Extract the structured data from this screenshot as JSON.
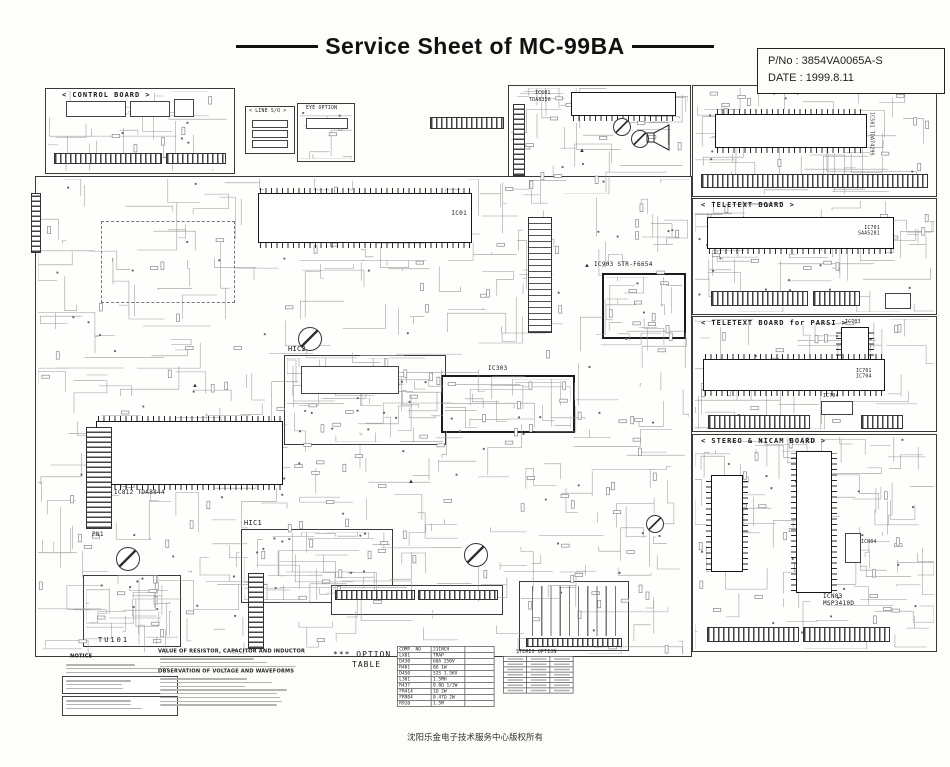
{
  "title": "Service Sheet of MC-99BA",
  "footer": "沈阳乐金电子技术服务中心版权所有",
  "info": {
    "pno": "P/No : 3854VA0065A-S",
    "date": "DATE : 1999.8.11"
  },
  "boards": {
    "control": {
      "label": "< CONTROL BOARD >"
    },
    "av_stereo": {
      "label": "< A/V STEREO BOARD >",
      "ic_ref": "IC501",
      "ic_part": "TDA7429S"
    },
    "teletext": {
      "label": "< TELETEXT BOARD >",
      "ic_ref": "IC701",
      "ic_part": "SAA5281"
    },
    "teletext_parsi": {
      "label": "< TELETEXT BOARD for PARSI >",
      "ic_ref": "IC701",
      "ic_part": "SAA5261",
      "ic2_ref": "IC703",
      "ic3_ref": "IC704"
    },
    "stereo_nicam": {
      "label": "< STEREO & NICAM BOARD >",
      "ic_ref": "ICN03",
      "ic_part": "MSP3410D",
      "ic2_ref": "ICN04"
    }
  },
  "main": {
    "ic01_ref": "IC01",
    "ic601_ref": "IC601",
    "ic601_part": "TDA8356",
    "ic903_ref": "IC903",
    "ic903_part": "STR-F6654",
    "ic812_ref": "IC812",
    "ic812_part": "TDA8844",
    "ic303_ref": "IC303",
    "hic1_ref": "HIC1",
    "hic2_ref": "HIC2",
    "tu101_ref": "TU101",
    "pn1_ref": "PN1",
    "line_so_label": "< LINE S/O >",
    "eye_option_label": "EYE OPTION"
  },
  "notes": {
    "notice": "NOTICE",
    "value_heading": "VALUE OF RESISTOR, CAPACITOR AND INDUCTOR",
    "observation_heading": "OBSERVATION OF VOLTAGE AND WAVEFORMS"
  },
  "option_table": {
    "label_line1": "*** OPTION",
    "label_line2": "TABLE",
    "headers": [
      "COMP. NO",
      "21INCH",
      ""
    ],
    "rows": [
      [
        "LX01",
        "TRAP",
        ""
      ],
      [
        "D430",
        "60A 250V",
        ""
      ],
      [
        "R401",
        "0Ω 1W",
        ""
      ],
      [
        "D450",
        "S2S 1.5KV",
        ""
      ],
      [
        "L301",
        "1.5MH",
        ""
      ],
      [
        "R437",
        "0.8Ω 1/2W",
        ""
      ],
      [
        "FR414",
        "1Ω 2W",
        ""
      ],
      [
        "FR904",
        "0.47Ω 2W",
        ""
      ],
      [
        "R910",
        "1.5M",
        ""
      ]
    ]
  },
  "stereo_option": {
    "title": "STEREO OPTION"
  }
}
